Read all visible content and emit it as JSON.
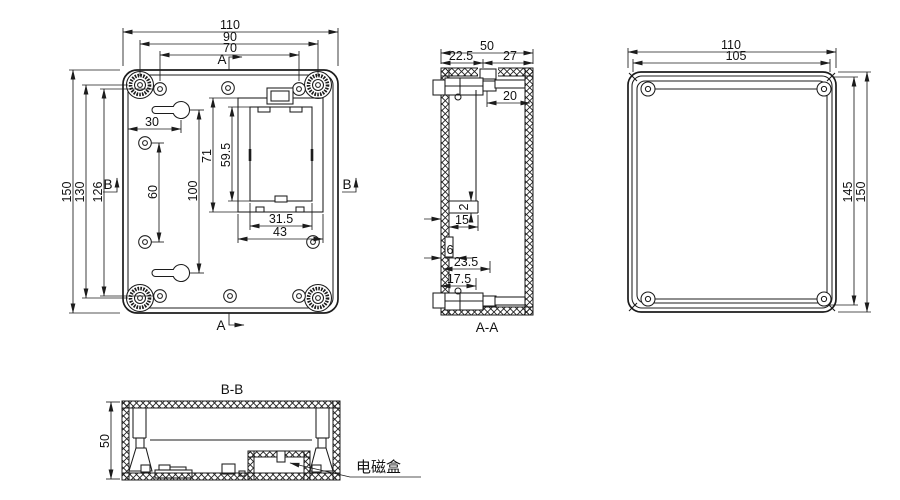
{
  "views": {
    "back": {
      "dim_width_overall": "110",
      "dim_width_bosses": "90",
      "dim_width_holes": "70",
      "dim_height_overall": "150",
      "dim_height_bosses": "130",
      "dim_height_holes": "126",
      "dim_keyhole_from_edge": "30",
      "dim_side_holes_spacing": "60",
      "dim_keyhole_spacing": "100",
      "dim_comp_outer_height": "71",
      "dim_comp_inner_height": "59.5",
      "dim_comp_inner_width": "31.5",
      "dim_comp_outer_width": "43"
    },
    "section_a": {
      "marker": "A",
      "label": "A-A",
      "dim_depth_overall": "50",
      "dim_depth_front": "22.5",
      "dim_depth_back": "27",
      "dim_shelf": "20",
      "dim_step": "2",
      "dim_rib": "15",
      "dim_notch": "6",
      "dim_slot_upper": "23.5",
      "dim_slot_lower": "17.5"
    },
    "front": {
      "dim_width_overall": "110",
      "dim_width_inner": "105",
      "dim_height_inner": "145",
      "dim_height_overall": "150"
    },
    "section_b": {
      "marker": "B",
      "label": "B-B",
      "dim_height": "50",
      "callout": "电磁盒"
    }
  }
}
